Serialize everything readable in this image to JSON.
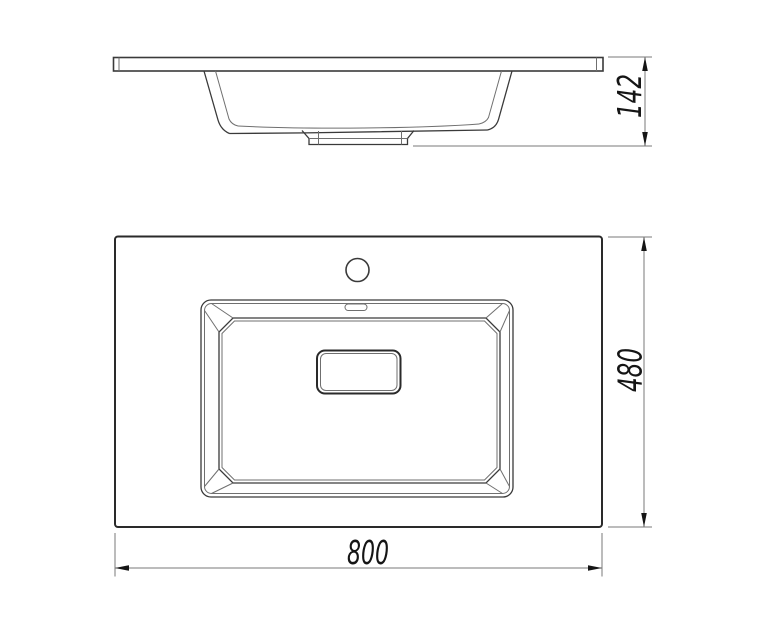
{
  "dimensions": {
    "side_height": "142",
    "plan_depth": "480",
    "plan_width": "800"
  },
  "colors": {
    "background": "#ffffff",
    "outline": "#3a3a3a",
    "bold_line": "#2a2a2a",
    "thin_line": "#6f6f6f",
    "dim_line": "#7a7a7a",
    "arrow": "#151515",
    "text": "#151515"
  }
}
